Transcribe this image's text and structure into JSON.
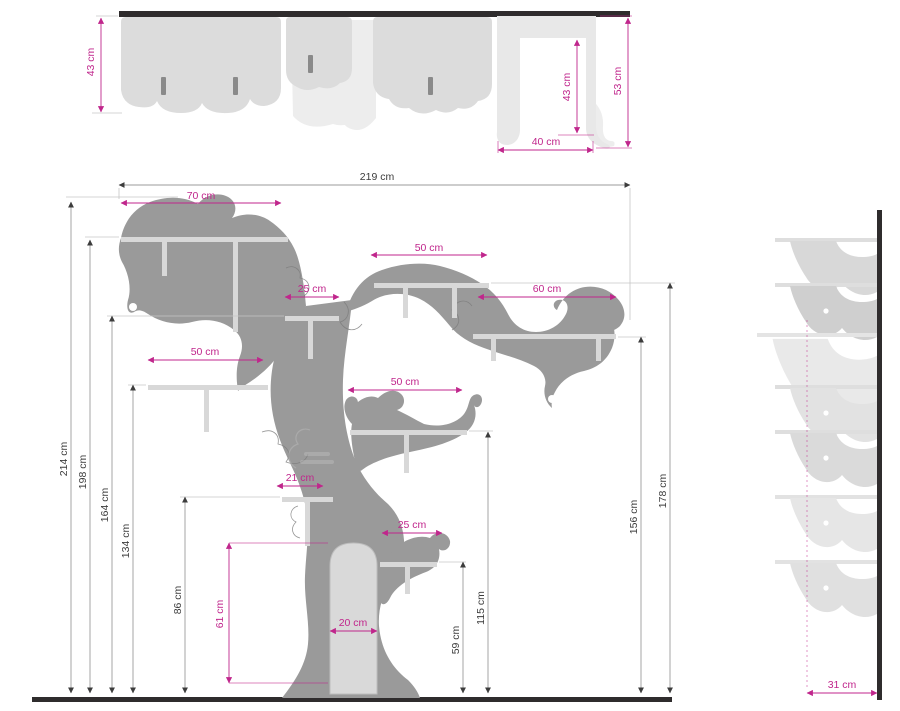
{
  "colors": {
    "pink": "#c0268c",
    "ink": "#3c3c3c",
    "tree": "#9a9a9a",
    "shelf": "#d8d8d8",
    "wall": "#2f2c2d",
    "panel": "#dcdcdc",
    "door": "#d9d9d9",
    "slot": "#8a8a8a"
  },
  "top_view": {
    "height_dims": [
      {
        "text": "43 cm"
      },
      {
        "text": "43 cm"
      },
      {
        "text": "53 cm"
      }
    ],
    "width_dims": [
      {
        "text": "40 cm"
      }
    ]
  },
  "front_view": {
    "overall_width": {
      "text": "219 cm"
    },
    "shelf_dims": [
      {
        "text": "70 cm"
      },
      {
        "text": "50 cm"
      },
      {
        "text": "25 cm"
      },
      {
        "text": "60 cm"
      },
      {
        "text": "50 cm"
      },
      {
        "text": "50 cm"
      },
      {
        "text": "21 cm"
      },
      {
        "text": "25 cm"
      },
      {
        "text": "20 cm"
      }
    ],
    "door_height": {
      "text": "61 cm"
    },
    "height_dims": [
      {
        "text": "214 cm"
      },
      {
        "text": "198 cm"
      },
      {
        "text": "164 cm"
      },
      {
        "text": "134 cm"
      },
      {
        "text": "86 cm"
      },
      {
        "text": "59 cm"
      },
      {
        "text": "115 cm"
      },
      {
        "text": "156 cm"
      },
      {
        "text": "178 cm"
      }
    ]
  },
  "side_view": {
    "depth_dim": {
      "text": "31 cm"
    }
  }
}
